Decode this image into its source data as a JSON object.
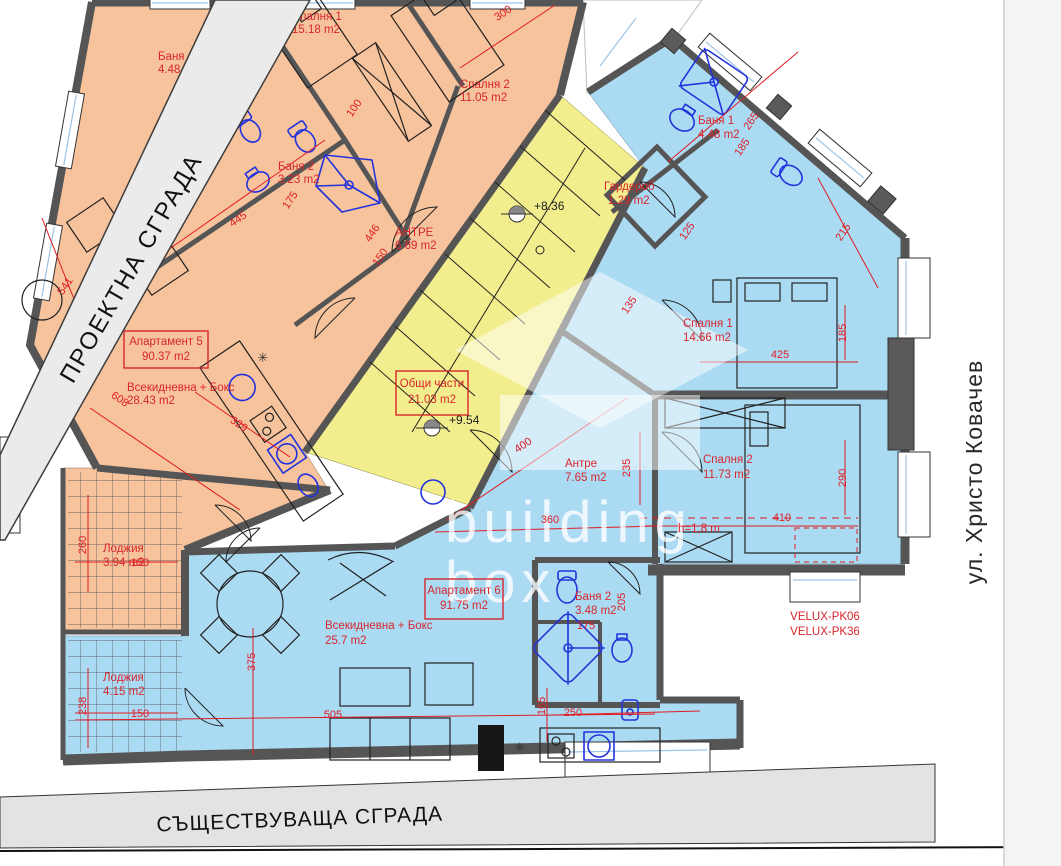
{
  "bands": {
    "projected": "ПРОЕКТНА СГРАДА",
    "existing": "СЪЩЕСТВУВАЩА СГРАДА",
    "street": "ул. Христо Ковачев"
  },
  "watermark": {
    "line1": "building",
    "line2": "box"
  },
  "common": {
    "name": "Общи части",
    "area": "21.03 m2",
    "elevation_upper": "+8.36",
    "elevation_lower": "+9.54"
  },
  "ap5": {
    "id_name": "Апартамент 5",
    "id_area": "90.37 m2",
    "rooms": {
      "spalnya1": {
        "name": "Спалня 1",
        "area": "15.18 m2"
      },
      "banya1": {
        "name": "Баня 1",
        "area": "4.48 m2"
      },
      "banya2": {
        "name": "Баня 2",
        "area": "3.23 m2"
      },
      "spalnya2": {
        "name": "Спалня 2",
        "area": "11.05 m2"
      },
      "antre": {
        "name": "АНТРЕ",
        "area": "6.69 m2"
      },
      "living": {
        "name": "Всекидневна + Бокс",
        "area": "28.43 m2"
      },
      "lodzhiya": {
        "name": "Лоджия",
        "area": "3.94 m2"
      }
    }
  },
  "ap6": {
    "id_name": "Апартамент 6",
    "id_area": "91.75 m2",
    "rooms": {
      "banya1": {
        "name": "Баня 1",
        "area": "4.48 m2"
      },
      "garderob": {
        "name": "Гардероб",
        "area": "1.29 m2"
      },
      "spalnya1": {
        "name": "Спалня 1",
        "area": "14.66 m2"
      },
      "spalnya2": {
        "name": "Спалня 2",
        "area": "11.73 m2"
      },
      "antre": {
        "name": "Антре",
        "area": "7.65 m2"
      },
      "banya2": {
        "name": "Баня 2",
        "area": "3.48 m2"
      },
      "living": {
        "name": "Всекидневна + Бокс",
        "area": "25.7 m2"
      },
      "lodzhiya": {
        "name": "Лоджия",
        "area": "4.15 m2"
      }
    }
  },
  "notes": {
    "velux_line1": "VELUX-PK06",
    "velux_line2": "VELUX-PK36",
    "attic_height": "h=1,8 m"
  },
  "dims": {
    "d300": "300",
    "d258": "258",
    "d185a": "185",
    "d175a": "175",
    "d100": "100",
    "d445": "445",
    "d446": "446",
    "d150a": "150",
    "d541": "541",
    "d608": "608",
    "d329": "329",
    "d260": "260",
    "d150o": "150",
    "d238": "238",
    "d150b": "150",
    "d135": "135",
    "d265": "265",
    "d185b": "185",
    "d215": "215",
    "d125": "125",
    "d425": "425",
    "d185r": "185",
    "d290": "290",
    "d410": "410",
    "d235": "235",
    "d400": "400",
    "d360": "360",
    "d375": "375",
    "d505": "505",
    "d165": "165",
    "d250": "250",
    "d175b": "175",
    "d205": "205"
  },
  "colors": {
    "apartment5_fill": "#f6c39c",
    "common_fill": "#f2ee8d",
    "apartment6_fill": "#abdbf3",
    "annotation_red": "#e01b22",
    "wall_gray": "#555555",
    "fixture_blue": "#2233dd"
  }
}
